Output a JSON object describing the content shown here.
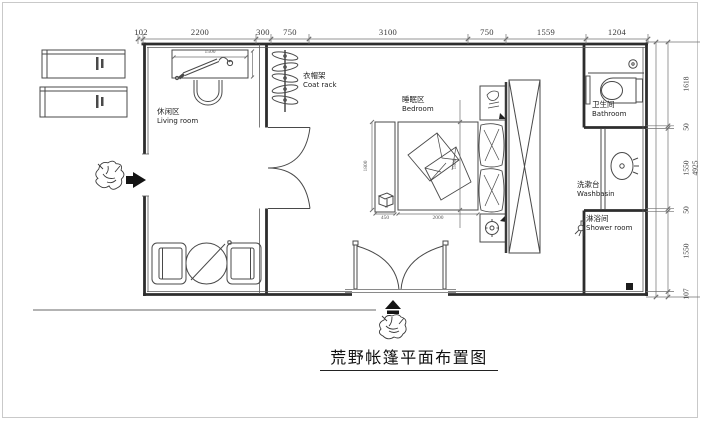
{
  "title": "荒野帐篷平面布置图",
  "rooms": {
    "living": {
      "zh": "休闲区",
      "en": "Living room"
    },
    "coat_rack": {
      "zh": "衣帽架",
      "en": "Coat rack"
    },
    "bedroom": {
      "zh": "睡眠区",
      "en": "Bedroom"
    },
    "bathroom": {
      "zh": "卫生间",
      "en": "Bathroom"
    },
    "washbasin": {
      "zh": "洗漱台",
      "en": "Washbasin"
    },
    "shower": {
      "zh": "淋浴间",
      "en": "Shower room"
    }
  },
  "dims": {
    "top": [
      "102",
      "2200",
      "300",
      "750",
      "3100",
      "750",
      "1559",
      "1204"
    ],
    "right": [
      "1618",
      "50",
      "1550",
      "50",
      "1550",
      "107"
    ],
    "right_total": "4925",
    "bed_width": "2000",
    "bench_width": "450",
    "bed_depth": "1800",
    "bench_depth": "1800",
    "desk_width": "1500"
  },
  "icons": {
    "entry_arrow_left": "solid right-pointing entrance arrow",
    "entry_arrow_bottom": "solid up-pointing entrance arrow",
    "wardrobe_cross": "x-crossed cabinet",
    "floor_drain": "black square drain"
  },
  "colors": {
    "wall": "#2d2d2d",
    "furniture": "#494949",
    "dimension": "#707070",
    "text": "#383838",
    "frame_border": "#c9c9c9",
    "background": "#ffffff"
  }
}
